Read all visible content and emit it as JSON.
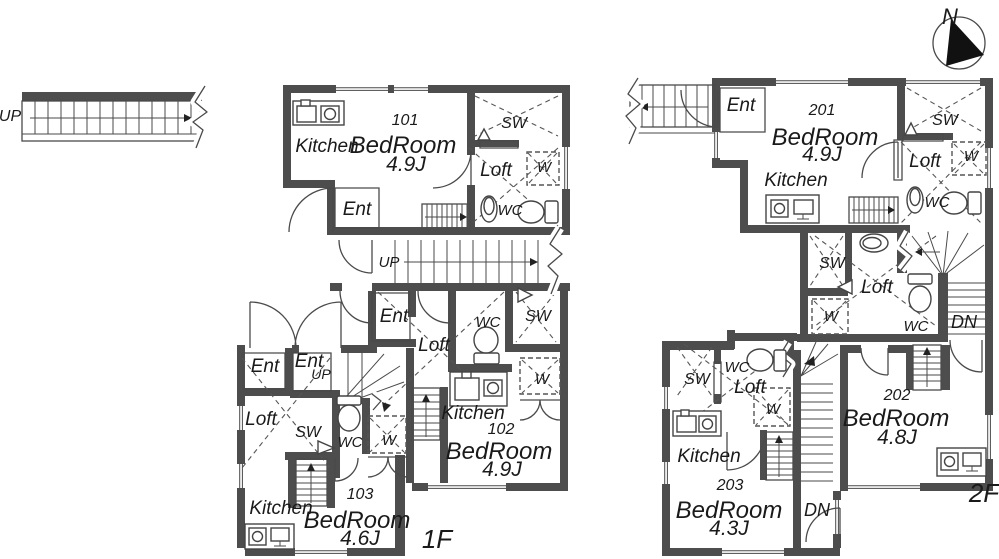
{
  "colors": {
    "wall": "#4d4d4d",
    "line": "#4a4a4a",
    "text": "#1a1a1a"
  },
  "site": {
    "approach_up": "UP",
    "north": "N"
  },
  "floor1": {
    "label": "1F",
    "hall_up": "UP",
    "u101": {
      "no": "101",
      "kitchen": "Kitchen",
      "bedroom": "BedRoom",
      "size": "4.9J",
      "ent": "Ent",
      "sw": "SW",
      "loft": "Loft",
      "w": "W",
      "wc": "WC"
    },
    "u102": {
      "no": "102",
      "kitchen": "Kitchen",
      "bedroom": "BedRoom",
      "size": "4.9J",
      "ent": "Ent",
      "sw": "SW",
      "loft": "Loft",
      "w": "W",
      "wc": "WC"
    },
    "u103": {
      "no": "103",
      "kitchen": "Kitchen",
      "bedroom": "BedRoom",
      "size": "4.6J",
      "ent": "Ent",
      "ent2": "Ent",
      "ent2_up": "UP",
      "sw": "SW",
      "loft": "Loft",
      "w": "W",
      "wc": "WC"
    }
  },
  "floor2": {
    "label": "2F",
    "u201": {
      "no": "201",
      "kitchen": "Kitchen",
      "bedroom": "BedRoom",
      "size": "4.9J",
      "ent": "Ent",
      "sw": "SW",
      "loft": "Loft",
      "w": "W",
      "wc": "WC"
    },
    "u202": {
      "no": "202",
      "bedroom": "BedRoom",
      "size": "4.8J",
      "sw": "SW",
      "loft": "Loft",
      "w": "W",
      "wc": "WC",
      "dn": "DN"
    },
    "u203": {
      "no": "203",
      "kitchen": "Kitchen",
      "bedroom": "BedRoom",
      "size": "4.3J",
      "sw": "SW",
      "loft": "Loft",
      "w": "W",
      "wc": "WC",
      "dn": "DN"
    }
  }
}
